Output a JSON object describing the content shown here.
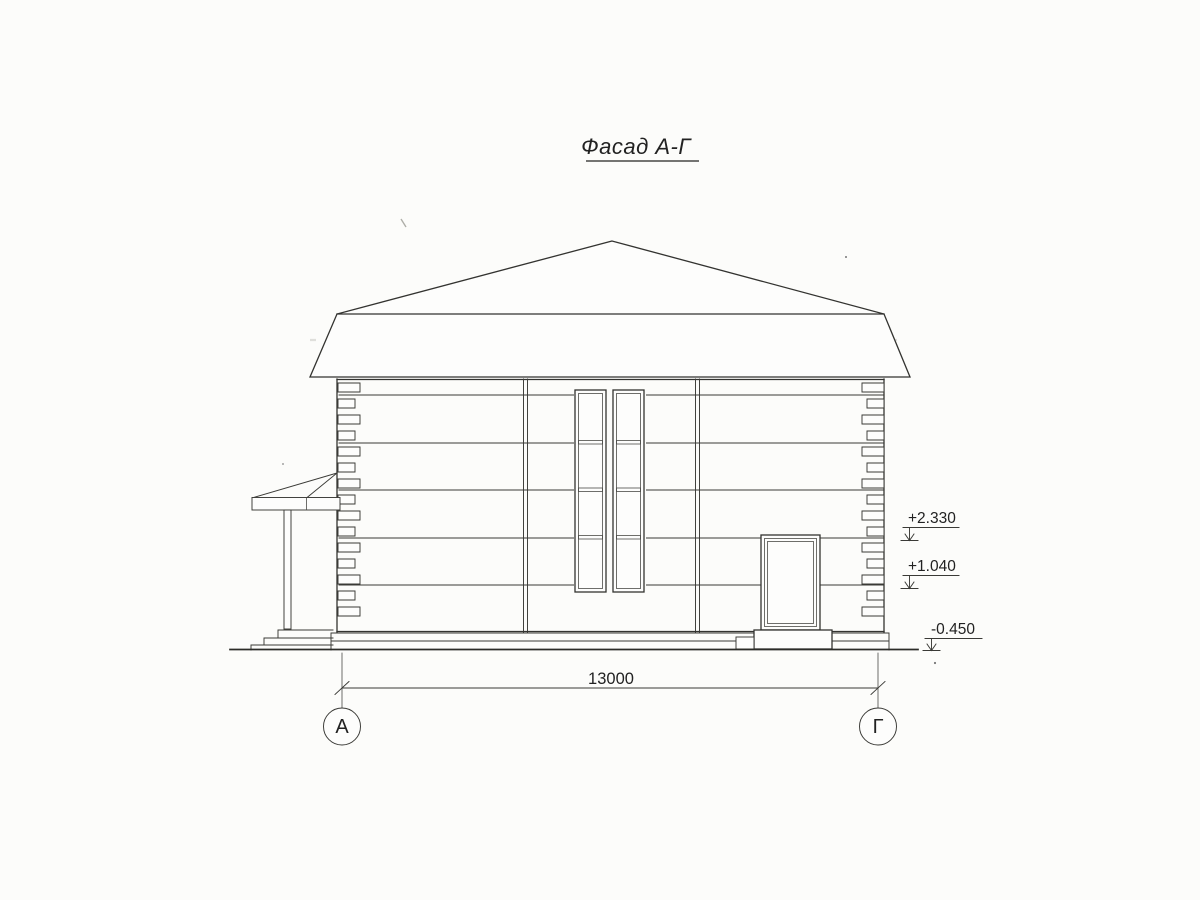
{
  "title": {
    "text": "Фасад А-Г"
  },
  "dimension": {
    "value": "13000"
  },
  "elevations": {
    "upper": "+2.330",
    "middle": "+1.040",
    "lower": "-0.450"
  },
  "axes": {
    "left": "А",
    "right": "Г"
  },
  "colors": {
    "ink": "#333330",
    "paper": "#fcfcfa"
  }
}
